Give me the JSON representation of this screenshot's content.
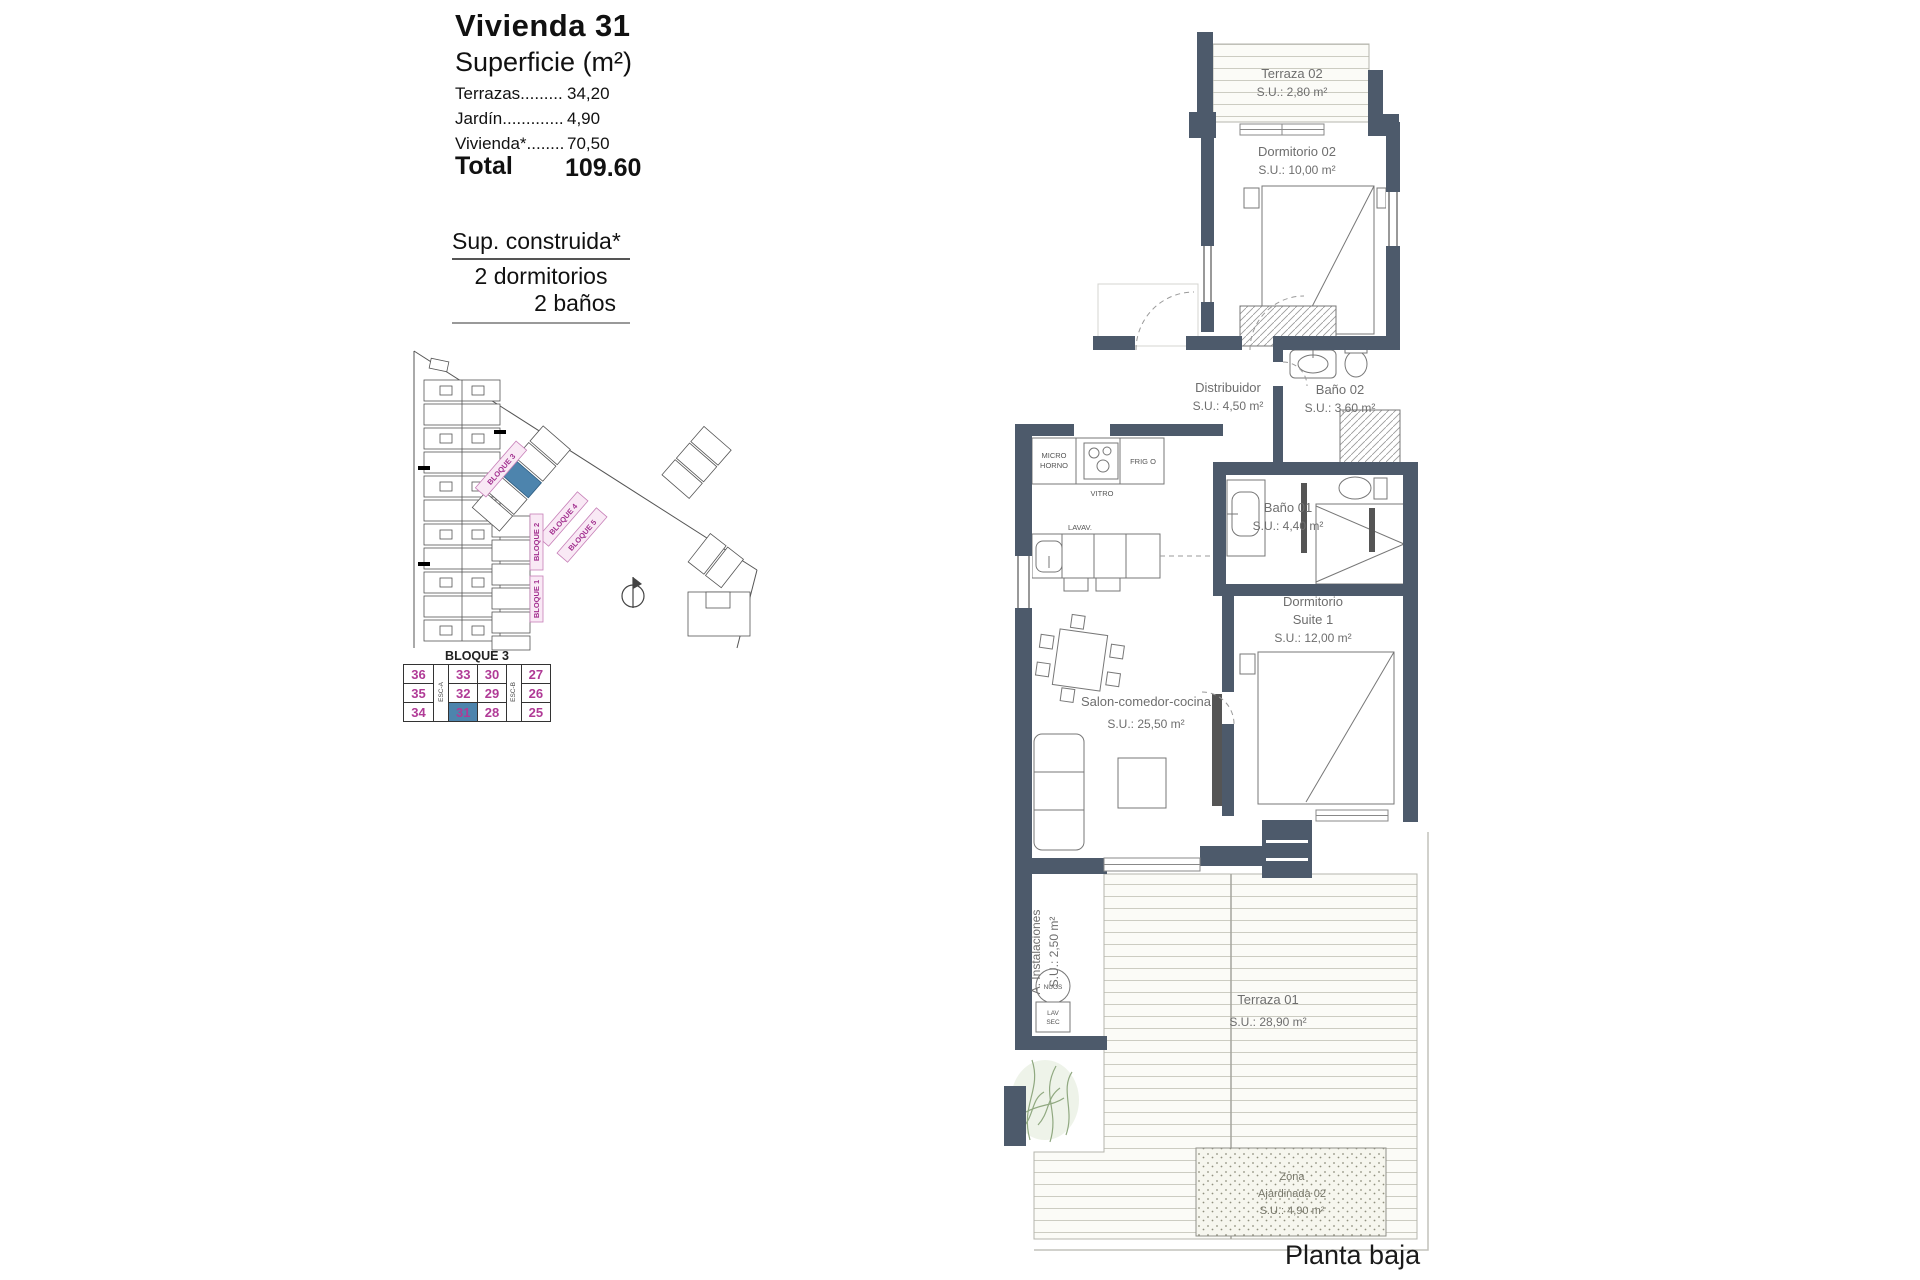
{
  "info": {
    "title": "Vivienda 31",
    "subtitle": "Superficie (m²)",
    "rows": [
      {
        "label": "Terrazas.........",
        "value": "34,20"
      },
      {
        "label": "Jardín.............",
        "value": "4,90"
      },
      {
        "label": "Vivienda*........",
        "value": "70,50"
      }
    ],
    "total_label": "Total",
    "total_value": "109.60",
    "built": [
      "Sup. construida*",
      "2 dormitorios",
      "2 baños"
    ]
  },
  "siteplan": {
    "bloque1": "BLOQUE 1",
    "bloque2": "BLOQUE 2",
    "bloque3": "BLOQUE 3",
    "bloque4": "BLOQUE 4",
    "bloque5": "BLOQUE 5"
  },
  "block_table": {
    "title": "BLOQUE 3",
    "esc_a": "ESC-A",
    "esc_b": "ESC-B",
    "highlighted": "31",
    "number_color": "#b03a96",
    "highlight_color": "#4d84ad",
    "rows": [
      [
        "36",
        "33",
        "30",
        "27"
      ],
      [
        "35",
        "32",
        "29",
        "26"
      ],
      [
        "34",
        "31",
        "28",
        "25"
      ]
    ]
  },
  "floorplan": {
    "wall_color": "#4d5a6b",
    "caption": "Planta baja",
    "rooms": {
      "terraza02": {
        "name": "Terraza 02",
        "su": "S.U.: 2,80 m²"
      },
      "dormitorio02": {
        "name": "Dormitorio 02",
        "su": "S.U.: 10,00 m²"
      },
      "distribuidor": {
        "name": "Distribuidor",
        "su": "S.U.: 4,50 m²"
      },
      "bano02": {
        "name": "Baño 02",
        "su": "S.U.: 3,60 m²"
      },
      "bano01": {
        "name": "Baño 01",
        "su": "S.U.: 4,40 m²"
      },
      "suite1": {
        "name1": "Dormitorio",
        "name2": "Suite 1",
        "su": "S.U.: 12,00 m²"
      },
      "salon": {
        "name": "Salon-comedor-cocina",
        "su": "S.U.: 25,50 m²"
      },
      "terraza01": {
        "name": "Terraza 01",
        "su": "S.U.: 28,90 m²"
      },
      "instalaciones": {
        "name": "A. Instalaciones",
        "su": "S.U.: 2,50 m²"
      },
      "zona": {
        "name1": "Zona",
        "name2": "Ajardinada 02",
        "su": "S.U.: 4,90 m²"
      }
    },
    "labels": {
      "micro1": "MICRO",
      "micro2": "HORNO",
      "vitro": "VITRO",
      "frigo": "FRIG O",
      "lavav": "LAVAV.",
      "nuos": "NUOS",
      "lav": "LAV",
      "sec": "SEC"
    }
  }
}
